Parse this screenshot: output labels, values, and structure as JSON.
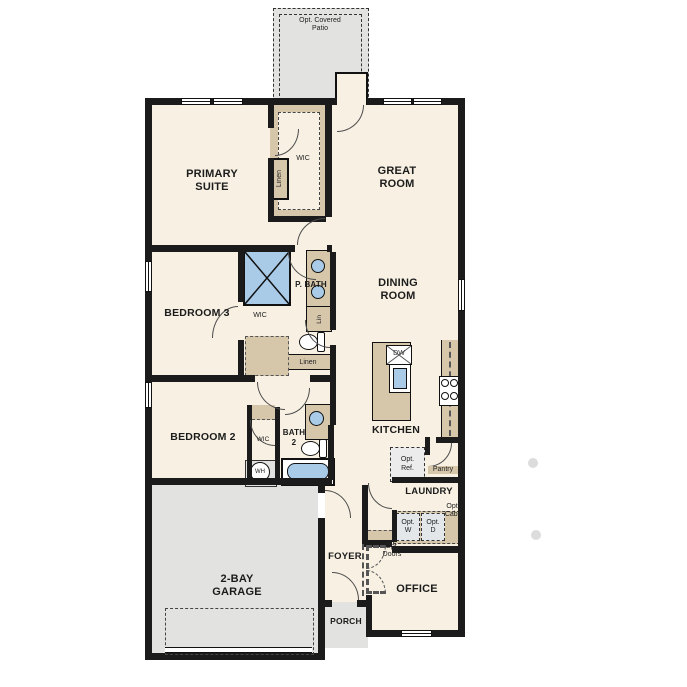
{
  "floorplan": {
    "labels": {
      "patio": "Opt. Covered Patio",
      "primary": "PRIMARY SUITE",
      "wic_primary": "WIC",
      "linen_primary": "Linen",
      "great": "GREAT ROOM",
      "bedroom3": "BEDROOM 3",
      "pbath": "P. BATH",
      "wic3": "WIC",
      "lin": "Lin",
      "linen_hall": "Linen",
      "dining": "DINING ROOM",
      "bedroom2": "BEDROOM 2",
      "wic2": "WIC",
      "bath2": "BATH 2",
      "wh": "WH",
      "kitchen": "KITCHEN",
      "dw": "DW",
      "opt_ref": "Opt. Ref.",
      "pantry": "Pantry",
      "laundry": "LAUNDRY",
      "opt_w": "Opt. W",
      "opt_d": "Opt. D",
      "opt_cabs": "Opt. Cabs",
      "foyer": "FOYER",
      "opt_doors": "Opt. Doors",
      "garage": "2-BAY GARAGE",
      "office": "OFFICE",
      "porch": "PORCH"
    },
    "colors": {
      "wall": "#1b1b1b",
      "room": "#f7f0e3",
      "closet": "#d6c7ab",
      "concrete": "#e2e2e0",
      "blue": "#a9cbe7",
      "optfill": "#ececec",
      "optblue": "#e3e7ea"
    }
  }
}
